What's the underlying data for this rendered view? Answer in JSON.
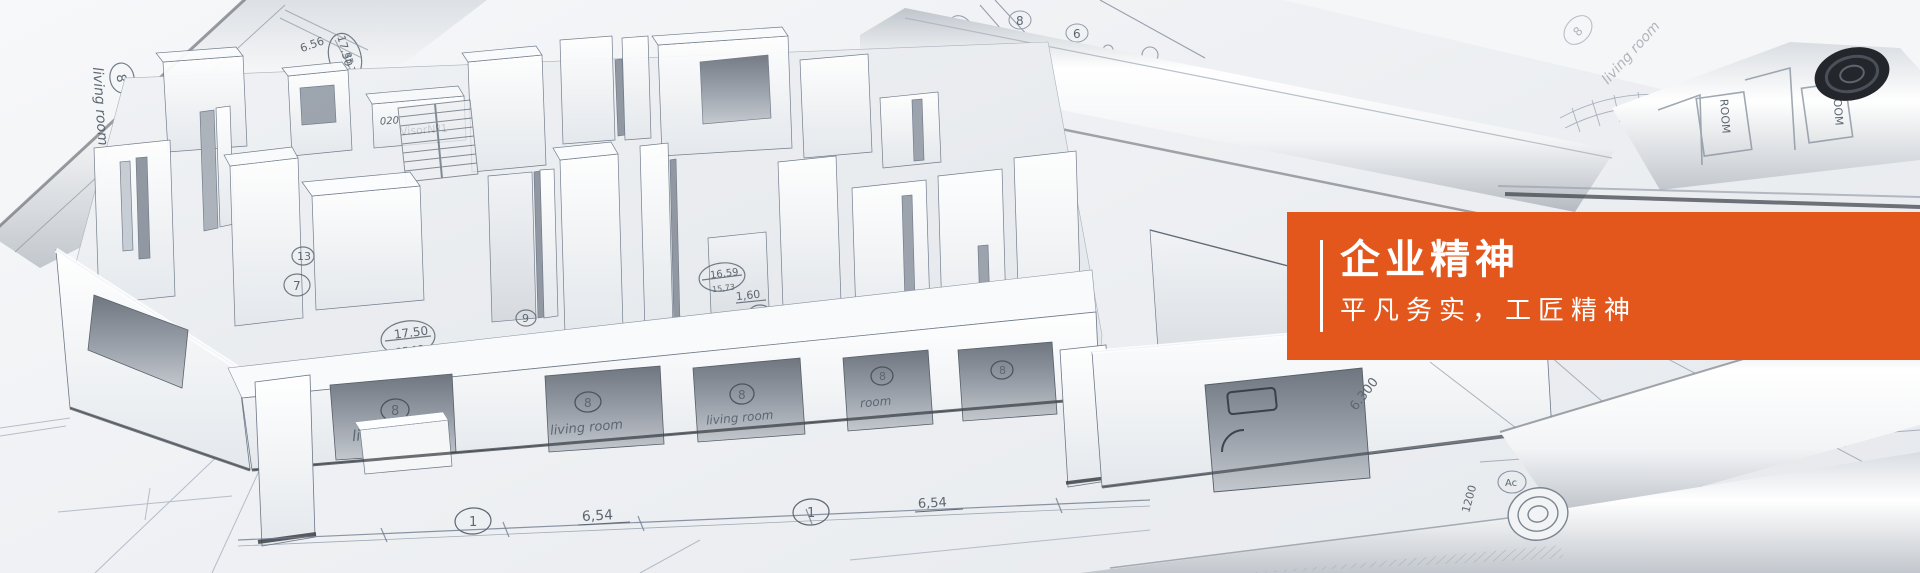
{
  "panel": {
    "title": "企业精神",
    "subtitle": "平凡务实，工匠精神",
    "accent_color": "#e3571d",
    "text_color": "#ffffff"
  },
  "blueprint": {
    "living_room": "living room",
    "room_short": "room",
    "room_print": "ROOM",
    "visor": "VisorNº1",
    "area_1750": "17.50",
    "area_3513": "35.13",
    "area_1659": "16,59",
    "area_1573": "15,73",
    "dim_654": "6,54",
    "dim_160": "1,60",
    "dim_656": "6.56",
    "dim_6300": "6.300",
    "dim_1200": "1200",
    "dim_020": "020",
    "c1": "1",
    "c6": "6",
    "c7": "7",
    "c8": "8",
    "c9": "9",
    "c13": "13",
    "cac": "Ac"
  }
}
